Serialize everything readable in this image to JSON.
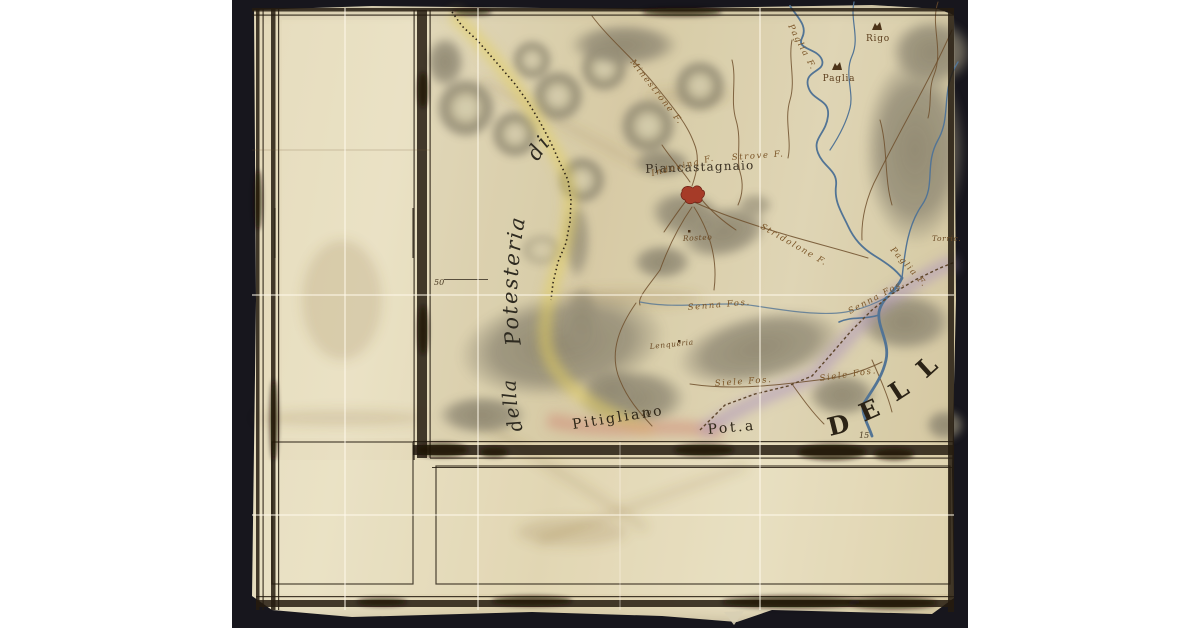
{
  "palette": {
    "photo-bg": "#17161d",
    "parchment": "#e6dcbc",
    "ink": "#2b2216",
    "brown": "#6f4f2b",
    "blue": "#527495",
    "red": "#a63b28",
    "yellow": "#e3cf5e",
    "pink": "#cf8f7c",
    "purple": "#a98fbe",
    "hill-gray": "#8d8672",
    "hill-light": "#dcd4b6"
  },
  "artifact": {
    "type": "manuscript map scan, hand-coloured, photographed on dark ground"
  },
  "map": {
    "settlements": {
      "piancastagnaio": "Piancastagnaio",
      "rigo": "Rigo",
      "paglia": "Paglia",
      "torre": "Torric."
    },
    "rivers": {
      "paglia_upper": "Paglia F.",
      "paglia_lower": "Paglia F.",
      "minestrone": "Minestrone F.",
      "stridolone": "Stridolone F.",
      "indovina": "Indovina F.",
      "strove": "Strove F.",
      "senna_west": "Senna Fos.",
      "senna_east": "Senna Fos.",
      "siele_west": "Siele Fos.",
      "siele_east": "Siele Fos."
    },
    "places": {
      "rosteo": "Rosteo",
      "lenqueria": "Lenqueria"
    },
    "territories": {
      "di": "di",
      "potesteria": "Potesteria",
      "della": "della",
      "pitigliano": "Pitigliano",
      "pot_abbrev": "Pot.a",
      "dell_letters": [
        "D",
        "E",
        "L",
        "L"
      ]
    },
    "margin_numbers": {
      "n50": "50",
      "n10": "10",
      "n15": "15"
    }
  }
}
